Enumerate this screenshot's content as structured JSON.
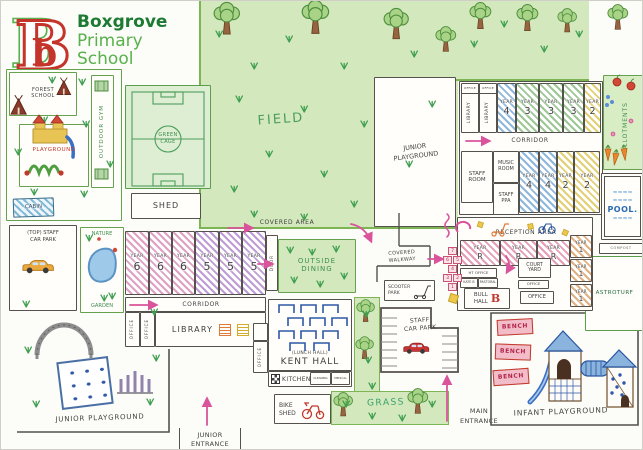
{
  "colors": {
    "accent_pink": "#d9549b",
    "map_green": "#4a9d5c",
    "logo_red": "#c5342b",
    "logo_green_dark": "#1d7a33",
    "logo_green_light": "#58b14c",
    "pool_blue": "#2b6cb0",
    "pencil": "#3f3f3f"
  },
  "logo": {
    "letter": "B",
    "letter_small": "b",
    "title": "Boxgrove",
    "subtitle1": "Primary",
    "subtitle2": "School"
  },
  "left_compound": {
    "forest_school_l1": "FOREST",
    "forest_school_l2": "SCHOOL",
    "outdoor_gym": "OUTDOOR GYM",
    "playground": "PLAYGROUND",
    "cabin": "CABIN"
  },
  "green_cage": {
    "line1": "GREEN",
    "line2": "CAGE"
  },
  "shed": "SHED",
  "field": "FIELD",
  "junior_playground_top": {
    "line1": "JUNIOR",
    "line2": "PLAYGROUND"
  },
  "top_block": {
    "office": "OFFICE",
    "library": "LIBRARY",
    "corridor": "CORRIDOR",
    "row1": [
      {
        "w": "YEAR",
        "n": "4"
      },
      {
        "w": "YEAR",
        "n": "3"
      },
      {
        "w": "YEAR",
        "n": "3"
      },
      {
        "w": "YEAR",
        "n": "3"
      },
      {
        "w": "YEAR",
        "n": "2"
      }
    ],
    "staff_room": {
      "l1": "STAFF",
      "l2": "ROOM"
    },
    "music_room": {
      "l1": "MUSIC",
      "l2": "ROOM"
    },
    "staff_ppa": {
      "l1": "STAFF",
      "l2": "PPA"
    },
    "row2": [
      {
        "w": "YEAR",
        "n": "4"
      },
      {
        "w": "YEAR",
        "n": "4"
      },
      {
        "w": "YEAR",
        "n": "2"
      },
      {
        "w": "YEAR",
        "n": "2"
      }
    ]
  },
  "allotments": "ALLOTMENTS",
  "pool": {
    "label": "POOL.",
    "wave": "≈≈≈≈"
  },
  "compost": "COMPOST",
  "reception": {
    "title": "RECEPTION AREA",
    "year_r": [
      {
        "w": "YEAR",
        "n": "R"
      },
      {
        "w": "YEAR",
        "n": "R"
      },
      {
        "w": "YEAR",
        "n": "R"
      }
    ],
    "year_1": [
      {
        "w": "YEAR",
        "n": "1"
      },
      {
        "w": "YEAR",
        "n": "1"
      },
      {
        "w": "YEAR",
        "n": "1"
      }
    ],
    "ht_office": "HT OFFICE",
    "kate_b": "KATE B",
    "pastoral": "PASTORAL",
    "court_yard": {
      "l1": "COURT",
      "l2": "YARD"
    },
    "office_small": "OFFICE",
    "office_main": "OFFICE",
    "bull_hall": {
      "l1": "BULL",
      "l2": "HALL",
      "logo": "B"
    }
  },
  "hopscotch": [
    "7",
    "6",
    "5",
    "4",
    "3",
    "2",
    "1"
  ],
  "astroturf": "ASTROTURF",
  "top_car_park": {
    "line1": "(TOP) STAFF",
    "line2": "CAR PARK"
  },
  "nature_garden": {
    "line1": "NATURE",
    "line2": "GARDEN"
  },
  "year_block": {
    "door": "DOOR",
    "rooms": [
      {
        "w": "YEAR",
        "n": "6"
      },
      {
        "w": "YEAR",
        "n": "6"
      },
      {
        "w": "YEAR",
        "n": "6"
      },
      {
        "w": "YEAR",
        "n": "5"
      },
      {
        "w": "YEAR",
        "n": "5"
      },
      {
        "w": "YEAR",
        "n": "5"
      }
    ]
  },
  "covered_area": "COVERED AREA",
  "outside_dining": {
    "line1": "OUTSIDE",
    "line2": "DINING"
  },
  "covered_walkway": {
    "line1": "COVERED",
    "line2": "WALKWAY"
  },
  "scooter_park": {
    "line1": "SCOOTER",
    "line2": "PARK"
  },
  "lower_block": {
    "corridor": "CORRIDOR",
    "office": "OFFICE",
    "library": "LIBRARY"
  },
  "kent_hall": {
    "sub": "(LUNCH HALL)",
    "name": "KENT HALL",
    "office": "OFFICE",
    "kitchen": "KITCHEN",
    "room1": "CLEANING",
    "room2": "MEDICAL"
  },
  "staff_car_park": {
    "line1": "STAFF",
    "line2": "CAR PARK"
  },
  "grass": "GRASS",
  "bike_shed": {
    "line1": "BIKE",
    "line2": "SHED"
  },
  "junior_entrance": {
    "line1": "JUNIOR",
    "line2": "ENTRANCE"
  },
  "main_entrance": {
    "line1": "MAIN",
    "line2": "ENTRANCE"
  },
  "infant_playground": {
    "label": "INFANT PLAYGROUND",
    "benches": [
      "BENCH",
      "BENCH",
      "BENCH"
    ]
  },
  "junior_playground_bottom": "JUNIOR PLAYGROUND"
}
